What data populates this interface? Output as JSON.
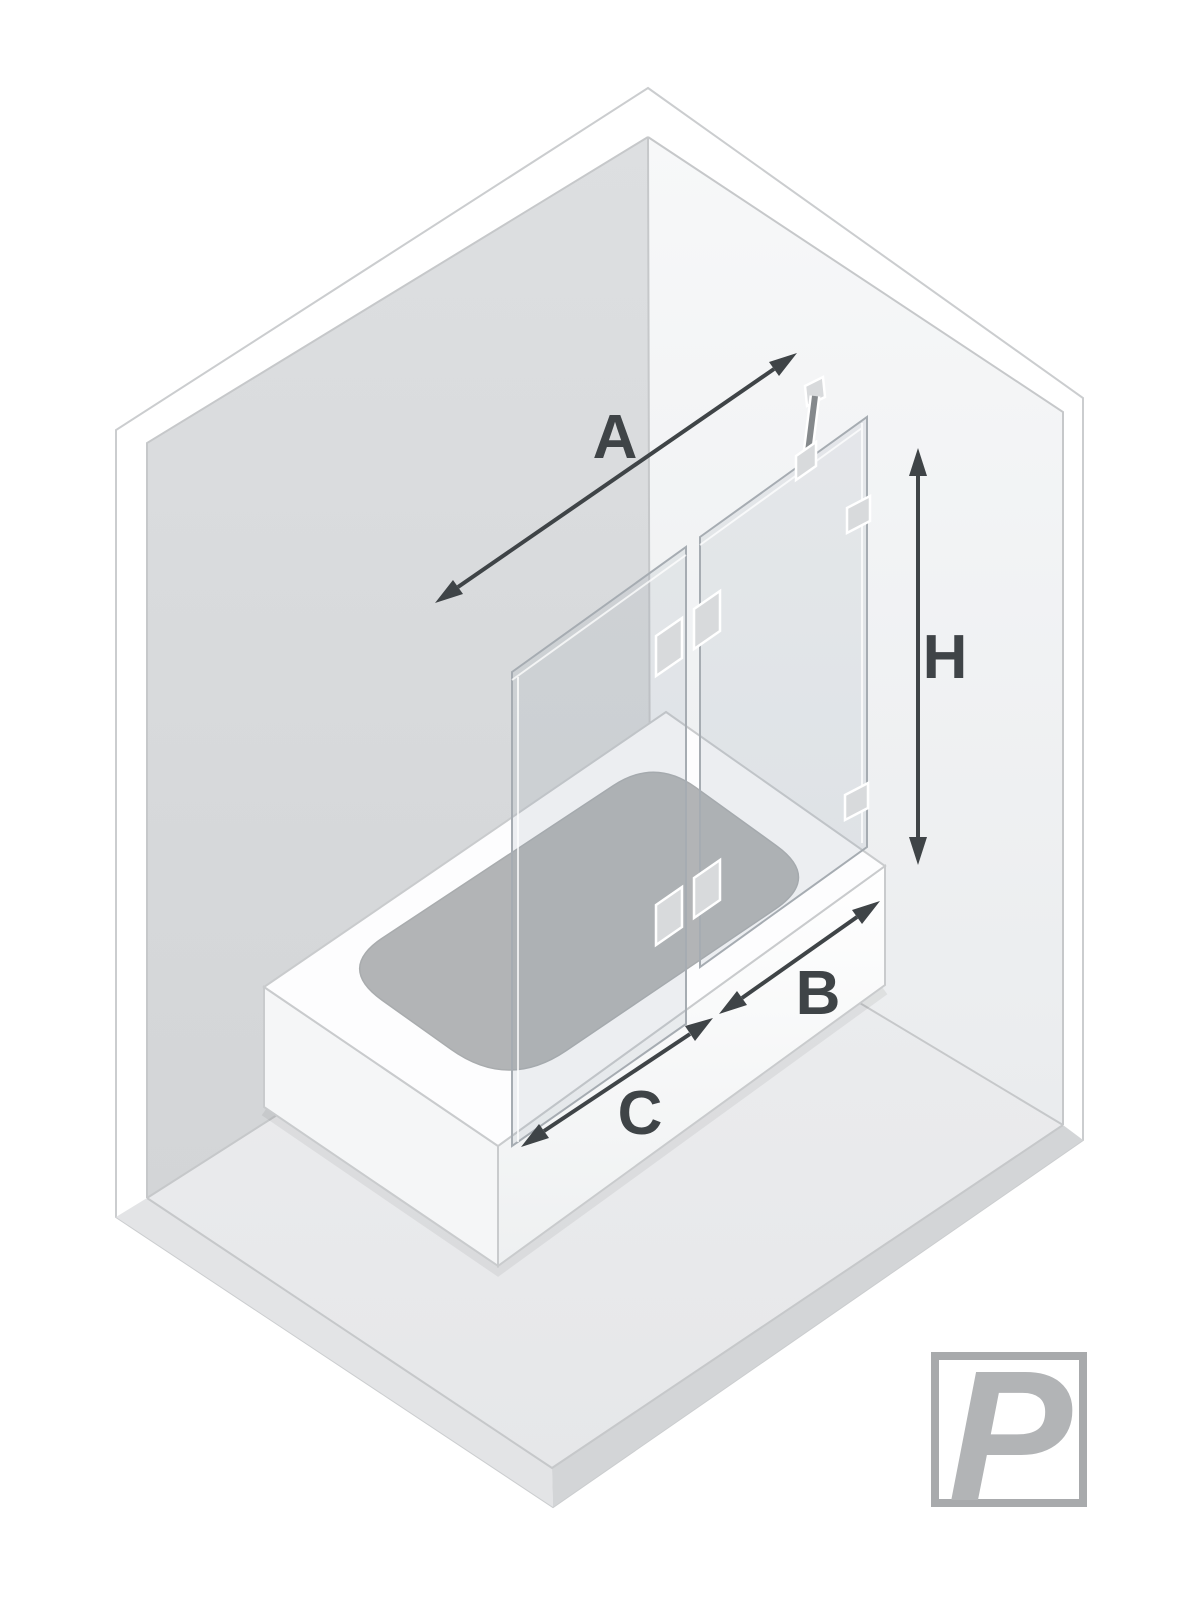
{
  "diagram": {
    "title": "bath-screen-dimension-diagram",
    "labels": {
      "total_width": "A",
      "height": "H",
      "fixed_panel_width": "B",
      "door_panel_width": "C"
    },
    "logo": {
      "letter": "P"
    },
    "icons": {
      "arrow_a": "double-headed-arrow-diagonal",
      "arrow_h": "double-headed-arrow-vertical",
      "arrow_b": "double-headed-arrow-diagonal",
      "arrow_c": "double-headed-arrow-diagonal"
    },
    "colors": {
      "dimension": "#3f4447",
      "wall_left": "#d8dadc",
      "wall_right": "#f3f4f5",
      "floor": "#eaebed",
      "floor_edge": "#d3d5d7",
      "tub_white": "#fdfdfe",
      "tub_interior": "#b2b4b6",
      "glass_edge": "#a6acb2",
      "hardware": "#d8dadc",
      "logo_gray": "#b2b4b6"
    }
  }
}
